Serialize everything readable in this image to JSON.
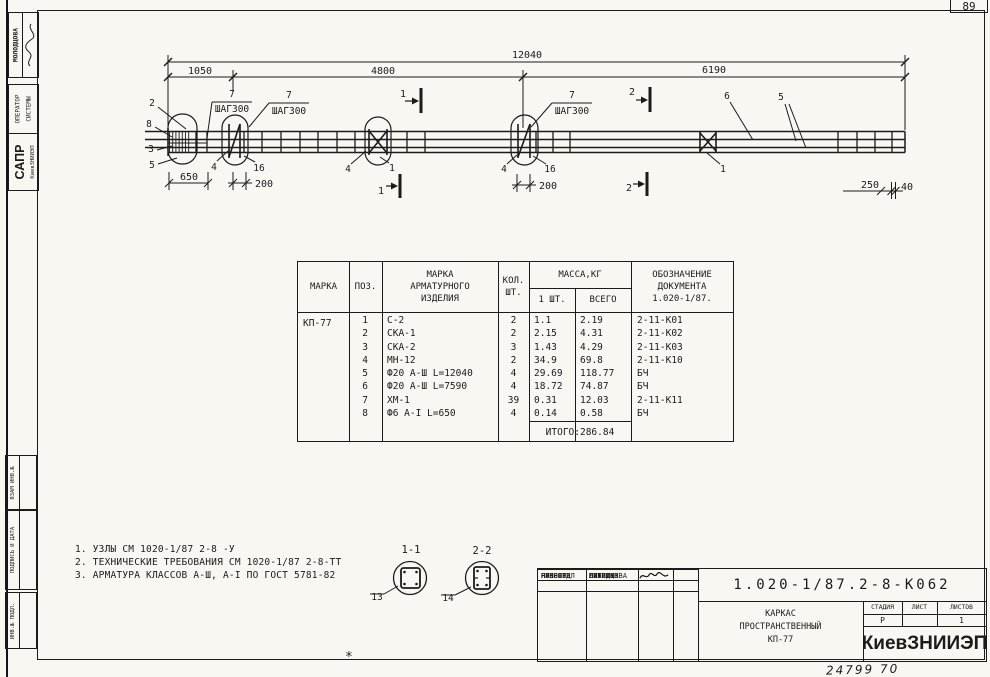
{
  "page": {
    "corner_number": "89",
    "plot_code": "24799  70",
    "registration_mark": "*"
  },
  "side_stamps": {
    "author": "МОЛОДЦОВА",
    "operator_line1": "ОПЕРАТОР",
    "operator_line2": "СИСТЕМЫ",
    "sapr_big": "САПР",
    "sapr_small": "КиевЗНИИЭП",
    "inv_boxes": [
      {
        "label": "ВЗАМ ИНВ.№"
      },
      {
        "label": "ПОДПИСЬ И ДАТА"
      },
      {
        "label": "ИНВ.№ ПОДЛ."
      }
    ]
  },
  "drawing": {
    "dim_total": "12040",
    "dim_seg1": "1050",
    "dim_seg2": "4800",
    "dim_seg3": "6190",
    "dim_650": "650",
    "dim_200": "200",
    "dim_250": "250",
    "dim_40": "40",
    "step_num": "7",
    "step_text": "ШАГ300",
    "cut1": "1",
    "cut2": "2",
    "pos1": "1",
    "pos2": "2",
    "pos3": "3",
    "pos4": "4",
    "pos5": "5",
    "pos6": "6",
    "pos8": "8",
    "pos13": "13",
    "pos14": "14",
    "pos16": "16",
    "section1": "1-1",
    "section2": "2-2"
  },
  "notes": [
    "1. УЗЛЫ СМ 1020-1/87 2-8 -У",
    "2. ТЕХНИЧЕСКИЕ ТРЕБОВАНИЯ СМ 1020-1/87 2-8-ТТ",
    "3. АРМАТУРА КЛАССОВ А-Ш, А-I ПО ГОСТ 5781-82"
  ],
  "parts_table": {
    "headers": {
      "marka": "МАРКА",
      "poz": "ПОЗ.",
      "item": "МАРКА\nАРМАТУРНОГО\nИЗДЕЛИЯ",
      "qty": "КОЛ.\nШТ.",
      "mass": "МАССА,КГ",
      "mass_one": "1 ШТ.",
      "mass_all": "ВСЕГО",
      "doc": "ОБОЗНАЧЕНИЕ\nДОКУМЕНТА\n1.020-1/87."
    },
    "marka": "КП-77",
    "rows": [
      {
        "poz": "1",
        "item": "С-2",
        "qty": "2",
        "m1": "1.1",
        "mall": "2.19",
        "doc": "2-11-К01"
      },
      {
        "poz": "2",
        "item": "СКА-1",
        "qty": "2",
        "m1": "2.15",
        "mall": "4.31",
        "doc": "2-11-К02"
      },
      {
        "poz": "3",
        "item": "СКА-2",
        "qty": "3",
        "m1": "1.43",
        "mall": "4.29",
        "doc": "2-11-К03"
      },
      {
        "poz": "4",
        "item": "МН-12",
        "qty": "2",
        "m1": "34.9",
        "mall": "69.8",
        "doc": "2-11-К10"
      },
      {
        "poz": "5",
        "item": "Ф20 А-Ш L=12040",
        "qty": "4",
        "m1": "29.69",
        "mall": "118.77",
        "doc": "БЧ"
      },
      {
        "poz": "6",
        "item": "Ф20 А-Ш L=7590",
        "qty": "4",
        "m1": "18.72",
        "mall": "74.87",
        "doc": "БЧ"
      },
      {
        "poz": "7",
        "item": "ХМ-1",
        "qty": "39",
        "m1": "0.31",
        "mall": "12.03",
        "doc": "2-11-К11"
      },
      {
        "poz": "8",
        "item": "Ф6 А-I L=650",
        "qty": "4",
        "m1": "0.14",
        "mall": "0.58",
        "doc": "БЧ"
      }
    ],
    "total": "ИТОГО:286.84"
  },
  "title_block": {
    "doc_number": "1.020-1/87.2-8-К062",
    "title_lines": "КАРКАС\nПРОСТРАНСТВЕННЫЙ\nКП-77",
    "org": "КиевЗНИИЭП",
    "stage_label": "СТАДИЯ",
    "sheet_label": "ЛИСТ",
    "sheets_label": "ЛИСТОВ",
    "stage_value": "Р",
    "sheet_value": "",
    "sheets_value": "1",
    "sign_rows": [
      {
        "role": "НАЧ ОТД",
        "name": "ГОРОХОВ"
      },
      {
        "role": "Н.КОНТР",
        "name": "СИТНИК"
      },
      {
        "role": "ГИП",
        "name": "СИТНИК"
      },
      {
        "role": "ПРОВЕРИЛ",
        "name": "ЛУКАШУК"
      },
      {
        "role": "РАЗРАБ.",
        "name": "МОЛОДЦОВА"
      }
    ]
  }
}
